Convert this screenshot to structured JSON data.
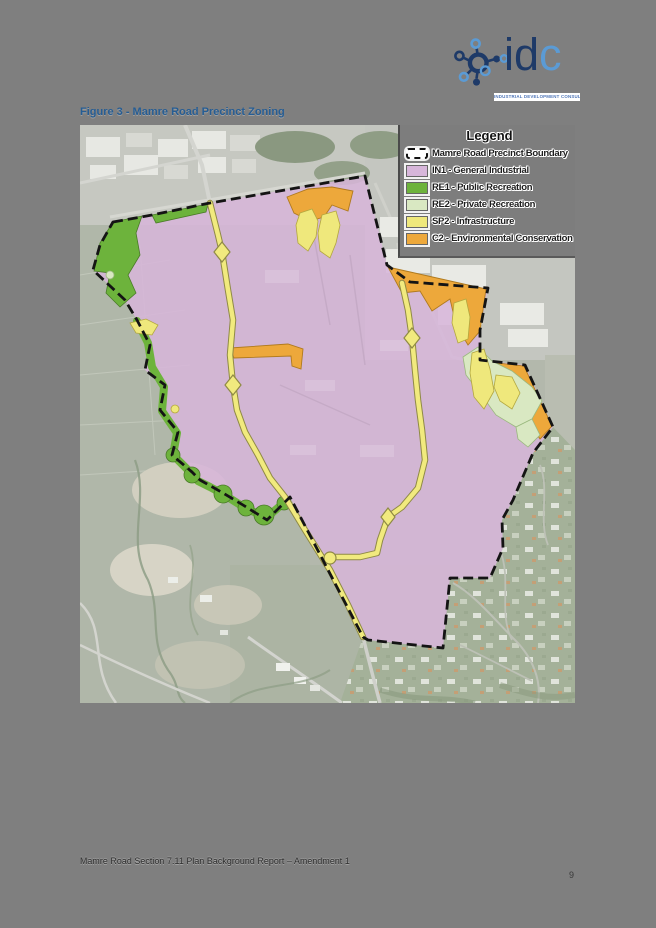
{
  "page": {
    "background_color": "#7f7f7f",
    "footer_text": "Mamre Road Section 7.11 Plan Background Report – Amendment 1",
    "page_number": "9"
  },
  "logo": {
    "name_dark": "id",
    "name_light": "c",
    "tagline": "INDUSTRIAL DEVELOPMENT CONSULTANCY",
    "navy": "#1e3a68",
    "light_blue": "#5b9bd5"
  },
  "figure": {
    "title": "Figure 3 - Mamre Road Precinct Zoning",
    "title_color": "#265d94"
  },
  "map": {
    "legend": {
      "title": "Legend",
      "boundary": {
        "label": "Mamre Road Precinct Boundary"
      },
      "items": [
        {
          "code": "IN1",
          "label": "IN1 - General Industrial",
          "color": "#d7b6da"
        },
        {
          "code": "RE1",
          "label": "RE1 - Public Recreation",
          "color": "#6db33c"
        },
        {
          "code": "RE2",
          "label": "RE2 - Private Recreation",
          "color": "#d9e8c2"
        },
        {
          "code": "SP2",
          "label": "SP2 - Infrastructure",
          "color": "#efe87c"
        },
        {
          "code": "C2",
          "label": "C2 - Environmental Conservation",
          "color": "#eda83b"
        }
      ]
    },
    "zone_colors": {
      "IN1": "#d7b6da",
      "RE1": "#6db33c",
      "RE2": "#d9e8c2",
      "SP2": "#efe87c",
      "C2": "#eda83b",
      "road": "#f1ea7e",
      "road_casing": "#8f8a45",
      "boundary": "#141414"
    }
  }
}
